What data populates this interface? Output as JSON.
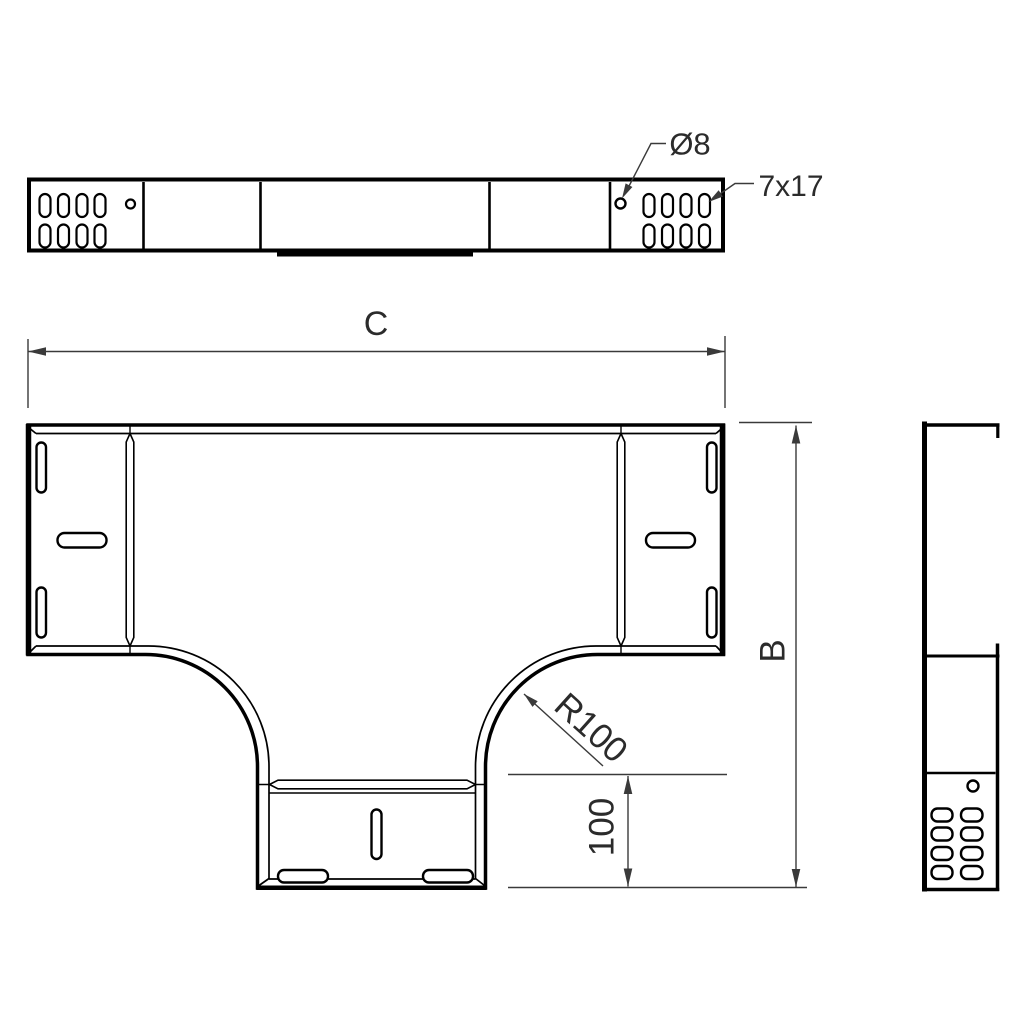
{
  "drawing": {
    "labels": {
      "length": "C",
      "height": "B",
      "radius": "R100",
      "branch_length": "100",
      "hole_diameter": "Ø8",
      "slot_size": "7x17"
    },
    "colors": {
      "line": "#000000",
      "dimension": "#3a3a3a",
      "text": "#2b2b2b",
      "background": "#ffffff"
    }
  }
}
